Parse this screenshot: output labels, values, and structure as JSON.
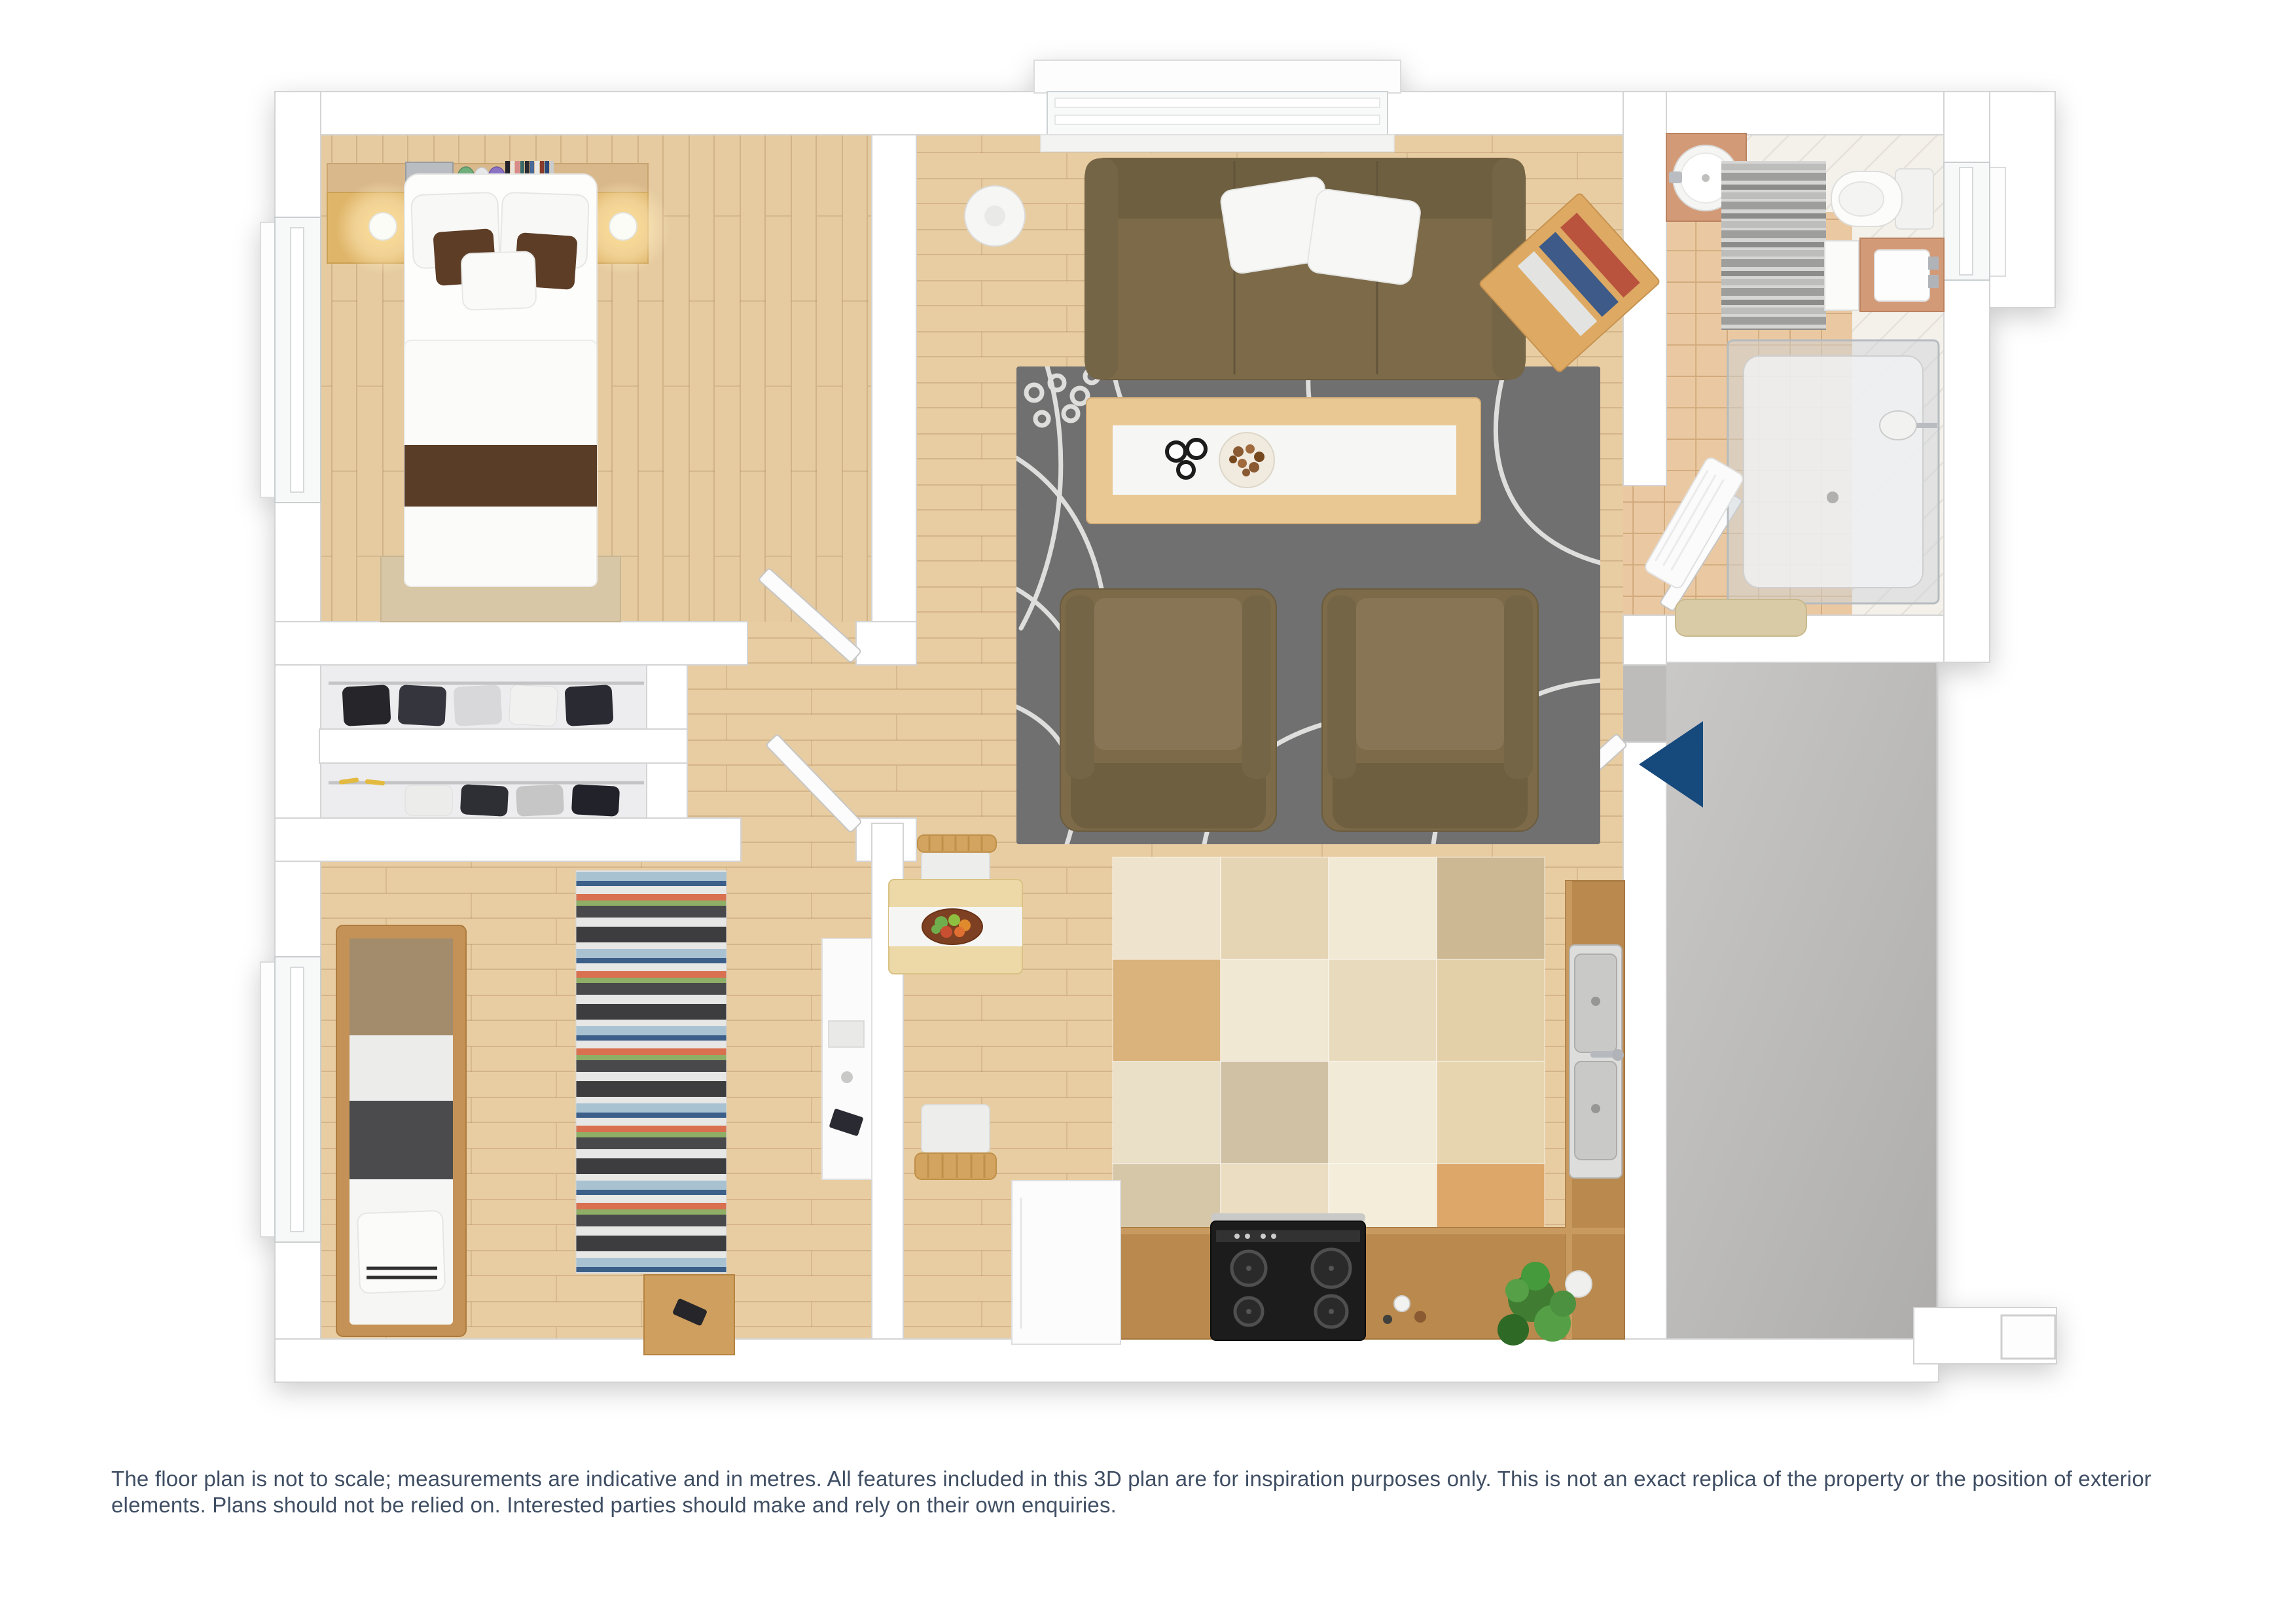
{
  "disclaimer": "The floor plan is not to scale; measurements are indicative and in metres. All features included in this 3D plan are for inspiration purposes only. This is not an exact replica of the property or the position of exterior elements. Plans should not be relied on. Interested parties should make and rely on their own enquiries.",
  "entrance_marker": {
    "icon": "entrance-arrow-icon",
    "shape": "triangle",
    "direction": "left"
  },
  "colors": {
    "accent-blue": "#16497B",
    "text-slate": "#3F4E63",
    "wall-white": "#FFFFFF",
    "floor-wood": "#E6CBA1",
    "tile-tan": "#EAC9A2",
    "terrace-gray": "#BDBCBA",
    "rug-gray": "#6F6F71",
    "sofa-olive": "#7B6A4A",
    "counter-wood": "#B9894E",
    "throw-brown": "#5A3C26"
  }
}
